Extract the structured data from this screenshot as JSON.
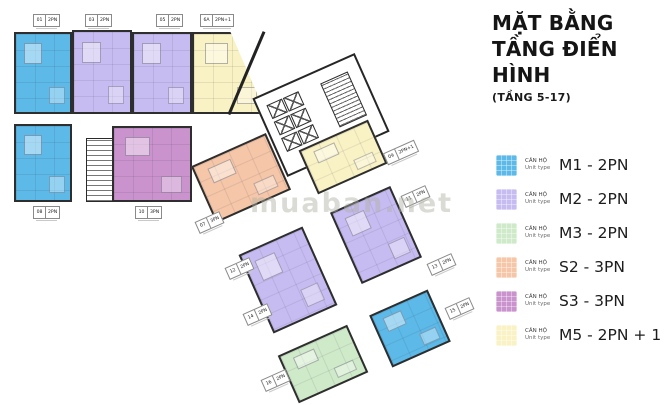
{
  "title": {
    "line1": "MẶT BẰNG",
    "line2": "TẦNG ĐIỂN HÌNH",
    "subtitle": "(TẦNG 5-17)"
  },
  "watermark": "muaban.net",
  "legend": {
    "caption_vi": "CĂN HỘ",
    "caption_en": "Unit type",
    "items": [
      {
        "name": "M1 - 2PN",
        "color": "#5cb9e8"
      },
      {
        "name": "M2 - 2PN",
        "color": "#c7bcf1"
      },
      {
        "name": "M3 - 2PN",
        "color": "#cfeac9"
      },
      {
        "name": "S2 - 3PN",
        "color": "#f5c6a8"
      },
      {
        "name": "S3 - 3PN",
        "color": "#ca93ce"
      },
      {
        "name": "M5 - 2PN + 1",
        "color": "#f9f2c4"
      }
    ]
  },
  "plan": {
    "units": [
      {
        "id": "m1-a",
        "type": "M1"
      },
      {
        "id": "m2-a",
        "type": "M2"
      },
      {
        "id": "m2-b",
        "type": "M2"
      },
      {
        "id": "m5-a",
        "type": "M5"
      },
      {
        "id": "m1-b",
        "type": "M1"
      },
      {
        "id": "s3-a",
        "type": "S3"
      },
      {
        "id": "s2-a",
        "type": "S2"
      },
      {
        "id": "m5-b",
        "type": "M5"
      },
      {
        "id": "m2-c",
        "type": "M2"
      },
      {
        "id": "m2-d",
        "type": "M2"
      },
      {
        "id": "m3-a",
        "type": "M3"
      },
      {
        "id": "m1-c",
        "type": "M1"
      }
    ],
    "tags": [
      {
        "num": "01",
        "type": "2PN"
      },
      {
        "num": "03",
        "type": "2PN"
      },
      {
        "num": "05",
        "type": "2PN"
      },
      {
        "num": "6A",
        "type": "2PN+1"
      },
      {
        "num": "08",
        "type": "2PN"
      },
      {
        "num": "10",
        "type": "3PN"
      },
      {
        "num": "07",
        "type": "3PN"
      },
      {
        "num": "09",
        "type": "2PN+1"
      },
      {
        "num": "11",
        "type": "2PN"
      },
      {
        "num": "13",
        "type": "2PN"
      },
      {
        "num": "15",
        "type": "2PN"
      },
      {
        "num": "12",
        "type": "2PN"
      },
      {
        "num": "14",
        "type": "2PN"
      },
      {
        "num": "16",
        "type": "2PN"
      }
    ]
  }
}
